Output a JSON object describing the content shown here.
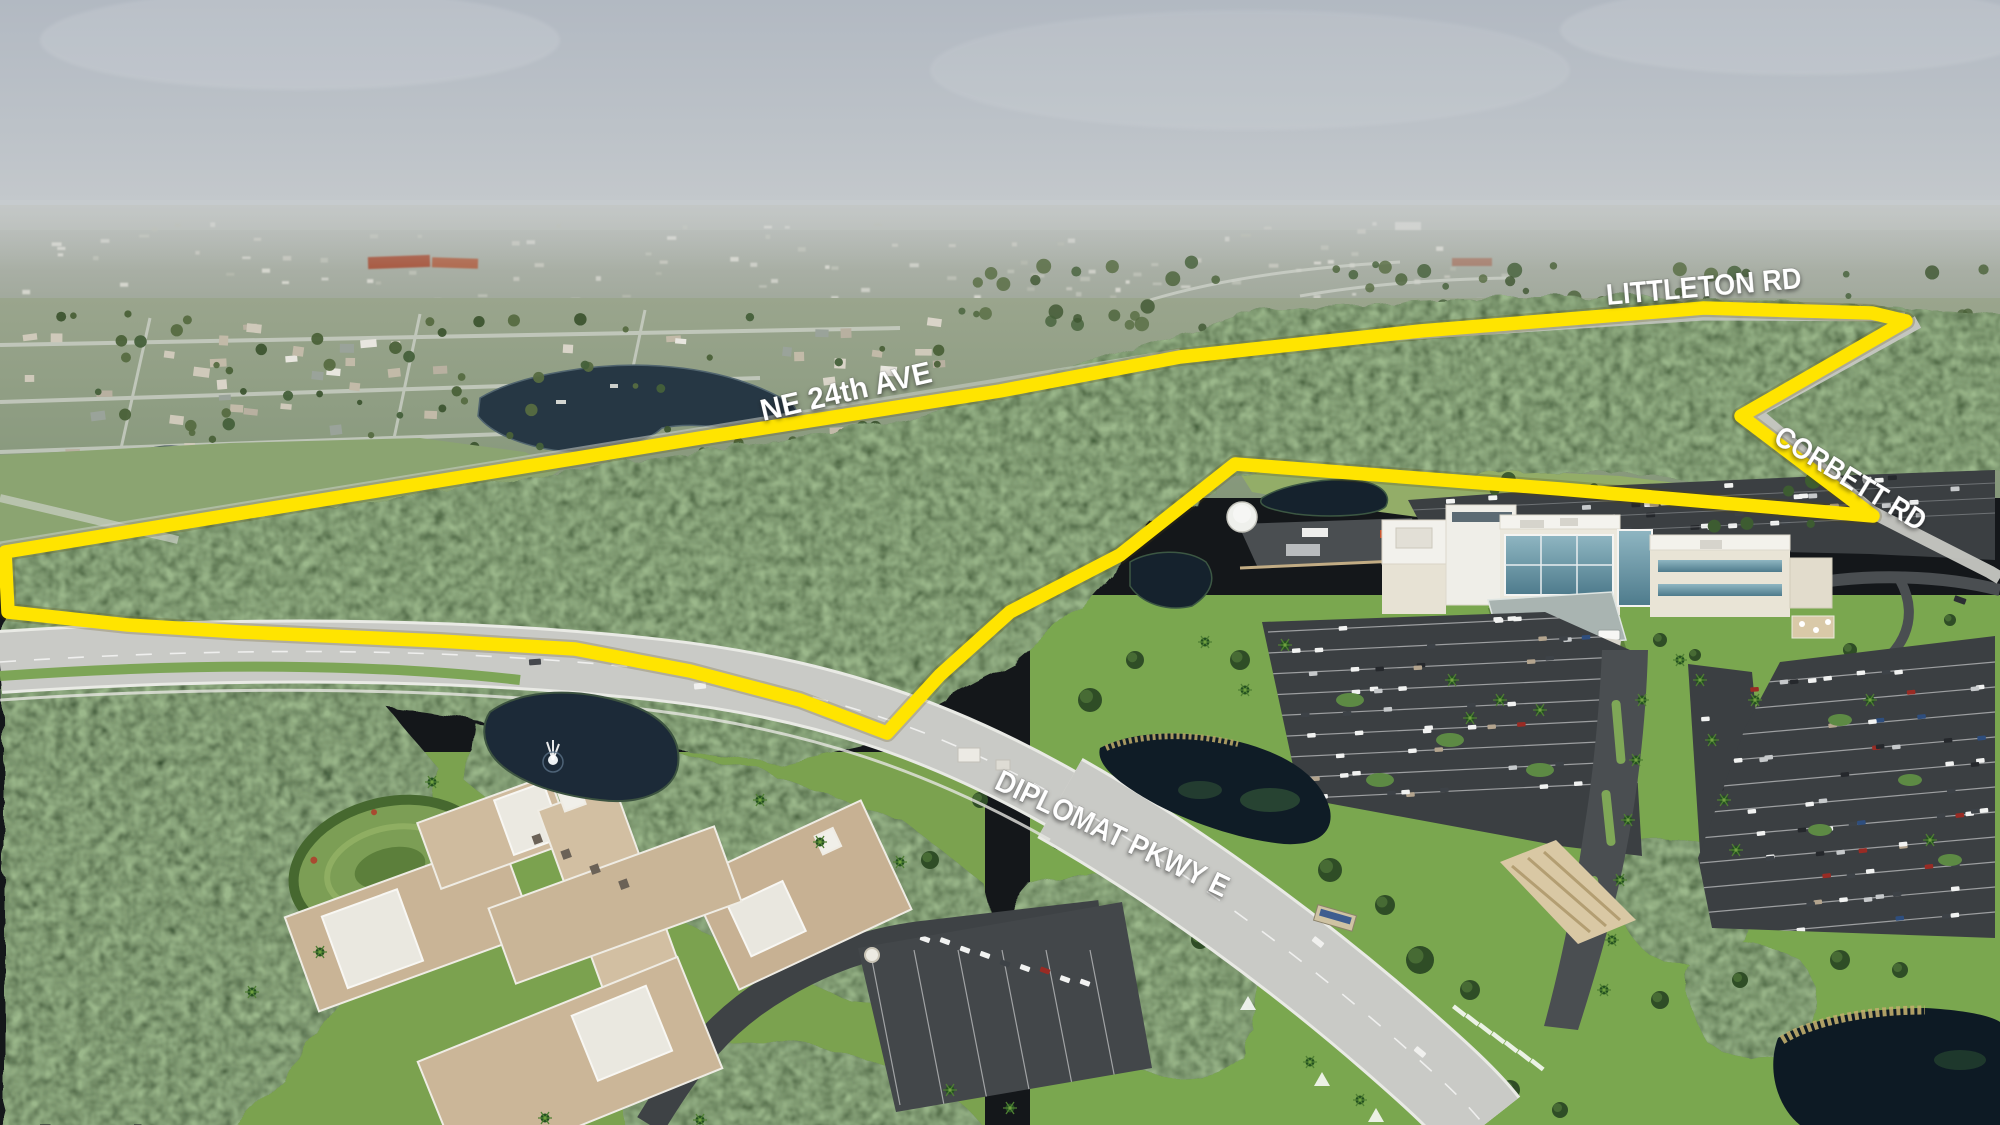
{
  "annotations": {
    "littleton_rd": {
      "text": "LITTLETON RD"
    },
    "ne_24th_ave": {
      "text": "NE 24th AVE"
    },
    "corbett_rd": {
      "text": "CORBETT RD"
    },
    "diplomat_pkwy_e": {
      "text": "DIPLOMAT PKWY E"
    }
  },
  "boundary": {
    "color": "#FFE400",
    "points": "5,552 340,497 700,438 1000,391 1180,357 1420,331 1704,308 1872,313 1906,321 1741,416 1873,516 1560,489 1235,464 1120,555 1010,612 940,675 887,733 800,700 690,671 575,649 440,641 240,632 128,625 8,612"
  },
  "palette": {
    "label_text": "#ffffff",
    "sky": "#b4bbc3",
    "haze": "#a9b0a2",
    "suburb": "#93a288",
    "forest": "#33502b",
    "deep_forest": "#2c4725",
    "pasture": "#8ba471",
    "lawn": "#7aa74f",
    "road": "#c9cac6",
    "asphalt": "#3b3f42",
    "water": "#1c2a38",
    "dark_pond": "#0f1c26",
    "condo_roof": "#c9b496",
    "hospital_wall": "#ebe8dd",
    "hospital_glass": "#6f9dab"
  }
}
